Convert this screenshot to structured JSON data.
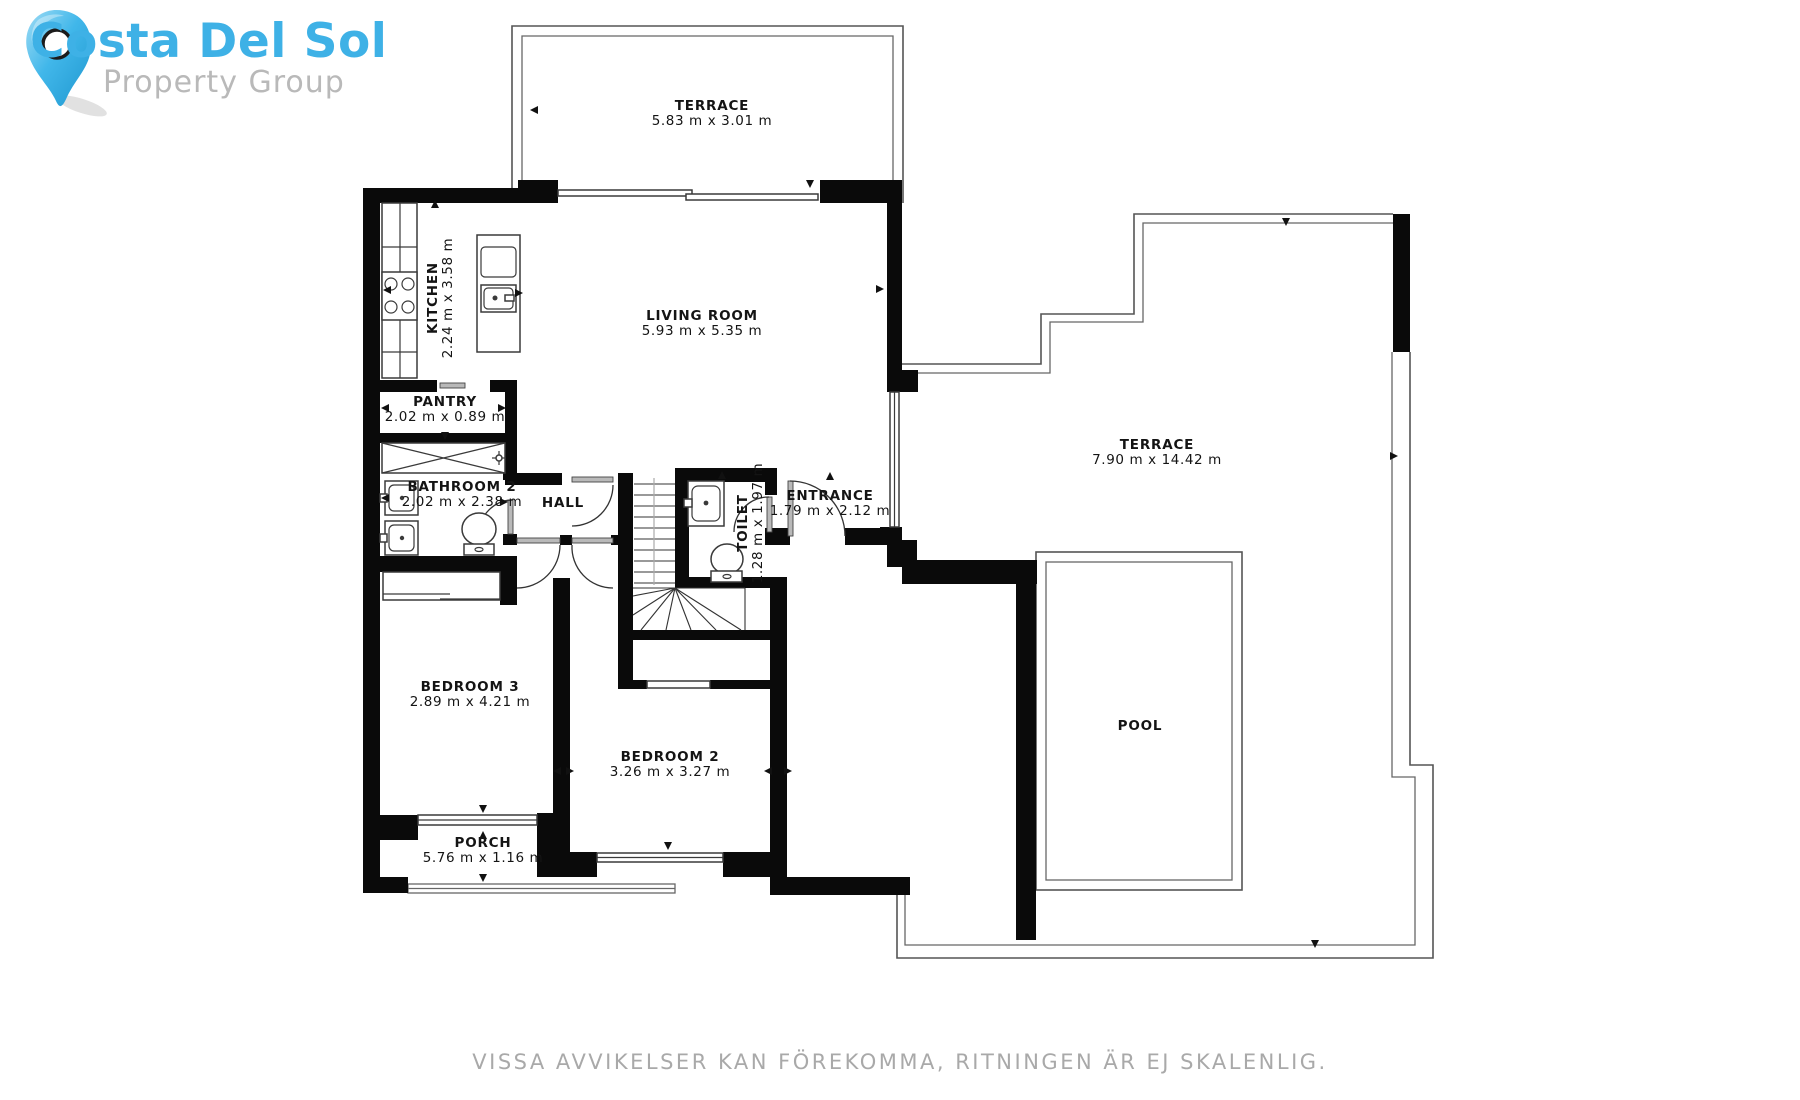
{
  "brand": {
    "line1": "Costa Del Sol",
    "line2": "Property Group",
    "colors": {
      "line1": "#3eb1e6",
      "line2": "#b9b9b9",
      "pin": "#41b7ea"
    }
  },
  "disclaimer": "VISSA AVVIKELSER KAN FÖREKOMMA, RITNINGEN ÄR EJ SKALENLIG.",
  "rooms": [
    {
      "id": "terrace-top",
      "name": "TERRACE",
      "dims": "5.83 m x 3.01 m",
      "x": 712,
      "y": 110,
      "rotate": 0
    },
    {
      "id": "living-room",
      "name": "LIVING ROOM",
      "dims": "5.93 m x 5.35 m",
      "x": 702,
      "y": 320,
      "rotate": 0
    },
    {
      "id": "kitchen",
      "name": "KITCHEN",
      "dims": "2.24 m x 3.58 m",
      "x": 437,
      "y": 298,
      "rotate": -90
    },
    {
      "id": "pantry",
      "name": "PANTRY",
      "dims": "2.02 m x 0.89 m",
      "x": 445,
      "y": 406,
      "rotate": 0
    },
    {
      "id": "bathroom-2",
      "name": "BATHROOM 2",
      "dims": "2.02 m x 2.38 m",
      "x": 462,
      "y": 491,
      "rotate": 0
    },
    {
      "id": "hall",
      "name": "HALL",
      "dims": "",
      "x": 563,
      "y": 502,
      "rotate": 0
    },
    {
      "id": "toilet",
      "name": "TOILET",
      "dims": "1.28 m x 1.97 m",
      "x": 747,
      "y": 523,
      "rotate": -90
    },
    {
      "id": "entrance",
      "name": "ENTRANCE",
      "dims": "1.79 m x 2.12 m",
      "x": 830,
      "y": 500,
      "rotate": 0
    },
    {
      "id": "terrace-right",
      "name": "TERRACE",
      "dims": "7.90 m x 14.42 m",
      "x": 1157,
      "y": 449,
      "rotate": 0
    },
    {
      "id": "bedroom-3",
      "name": "BEDROOM 3",
      "dims": "2.89 m x 4.21 m",
      "x": 470,
      "y": 691,
      "rotate": 0
    },
    {
      "id": "bedroom-2",
      "name": "BEDROOM 2",
      "dims": "3.26 m x 3.27 m",
      "x": 670,
      "y": 761,
      "rotate": 0
    },
    {
      "id": "porch",
      "name": "PORCH",
      "dims": "5.76 m x 1.16 m",
      "x": 483,
      "y": 847,
      "rotate": 0
    },
    {
      "id": "pool",
      "name": "POOL",
      "dims": "",
      "x": 1140,
      "y": 725,
      "rotate": 0
    }
  ]
}
